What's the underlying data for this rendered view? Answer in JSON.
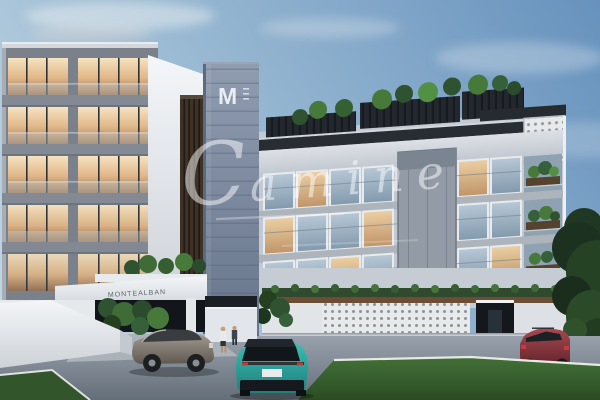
{
  "watermark": {
    "initial": "C",
    "rest": "amine"
  },
  "tower": {
    "logo": "M"
  },
  "canopy": {
    "sign_text": "MONTEALBAN"
  },
  "palette": {
    "sky_top": "#6792bd",
    "sky_horizon": "#c3d7e4",
    "tower_blue_gray": "#7d8ba0",
    "facade_light": "#c9ccd2",
    "warm_window": "#e0b687",
    "cool_window": "#9db1c2",
    "wood_louver": "#3e3227",
    "lattice_wall": "#e7e9ea",
    "lawn_green": "#3c6a33",
    "road_gray": "#7e8994",
    "car_teal": "#2fb3ad",
    "car_red": "#8c3340",
    "suv_gray": "#8a8178",
    "plant_green": "#3f6b37"
  }
}
